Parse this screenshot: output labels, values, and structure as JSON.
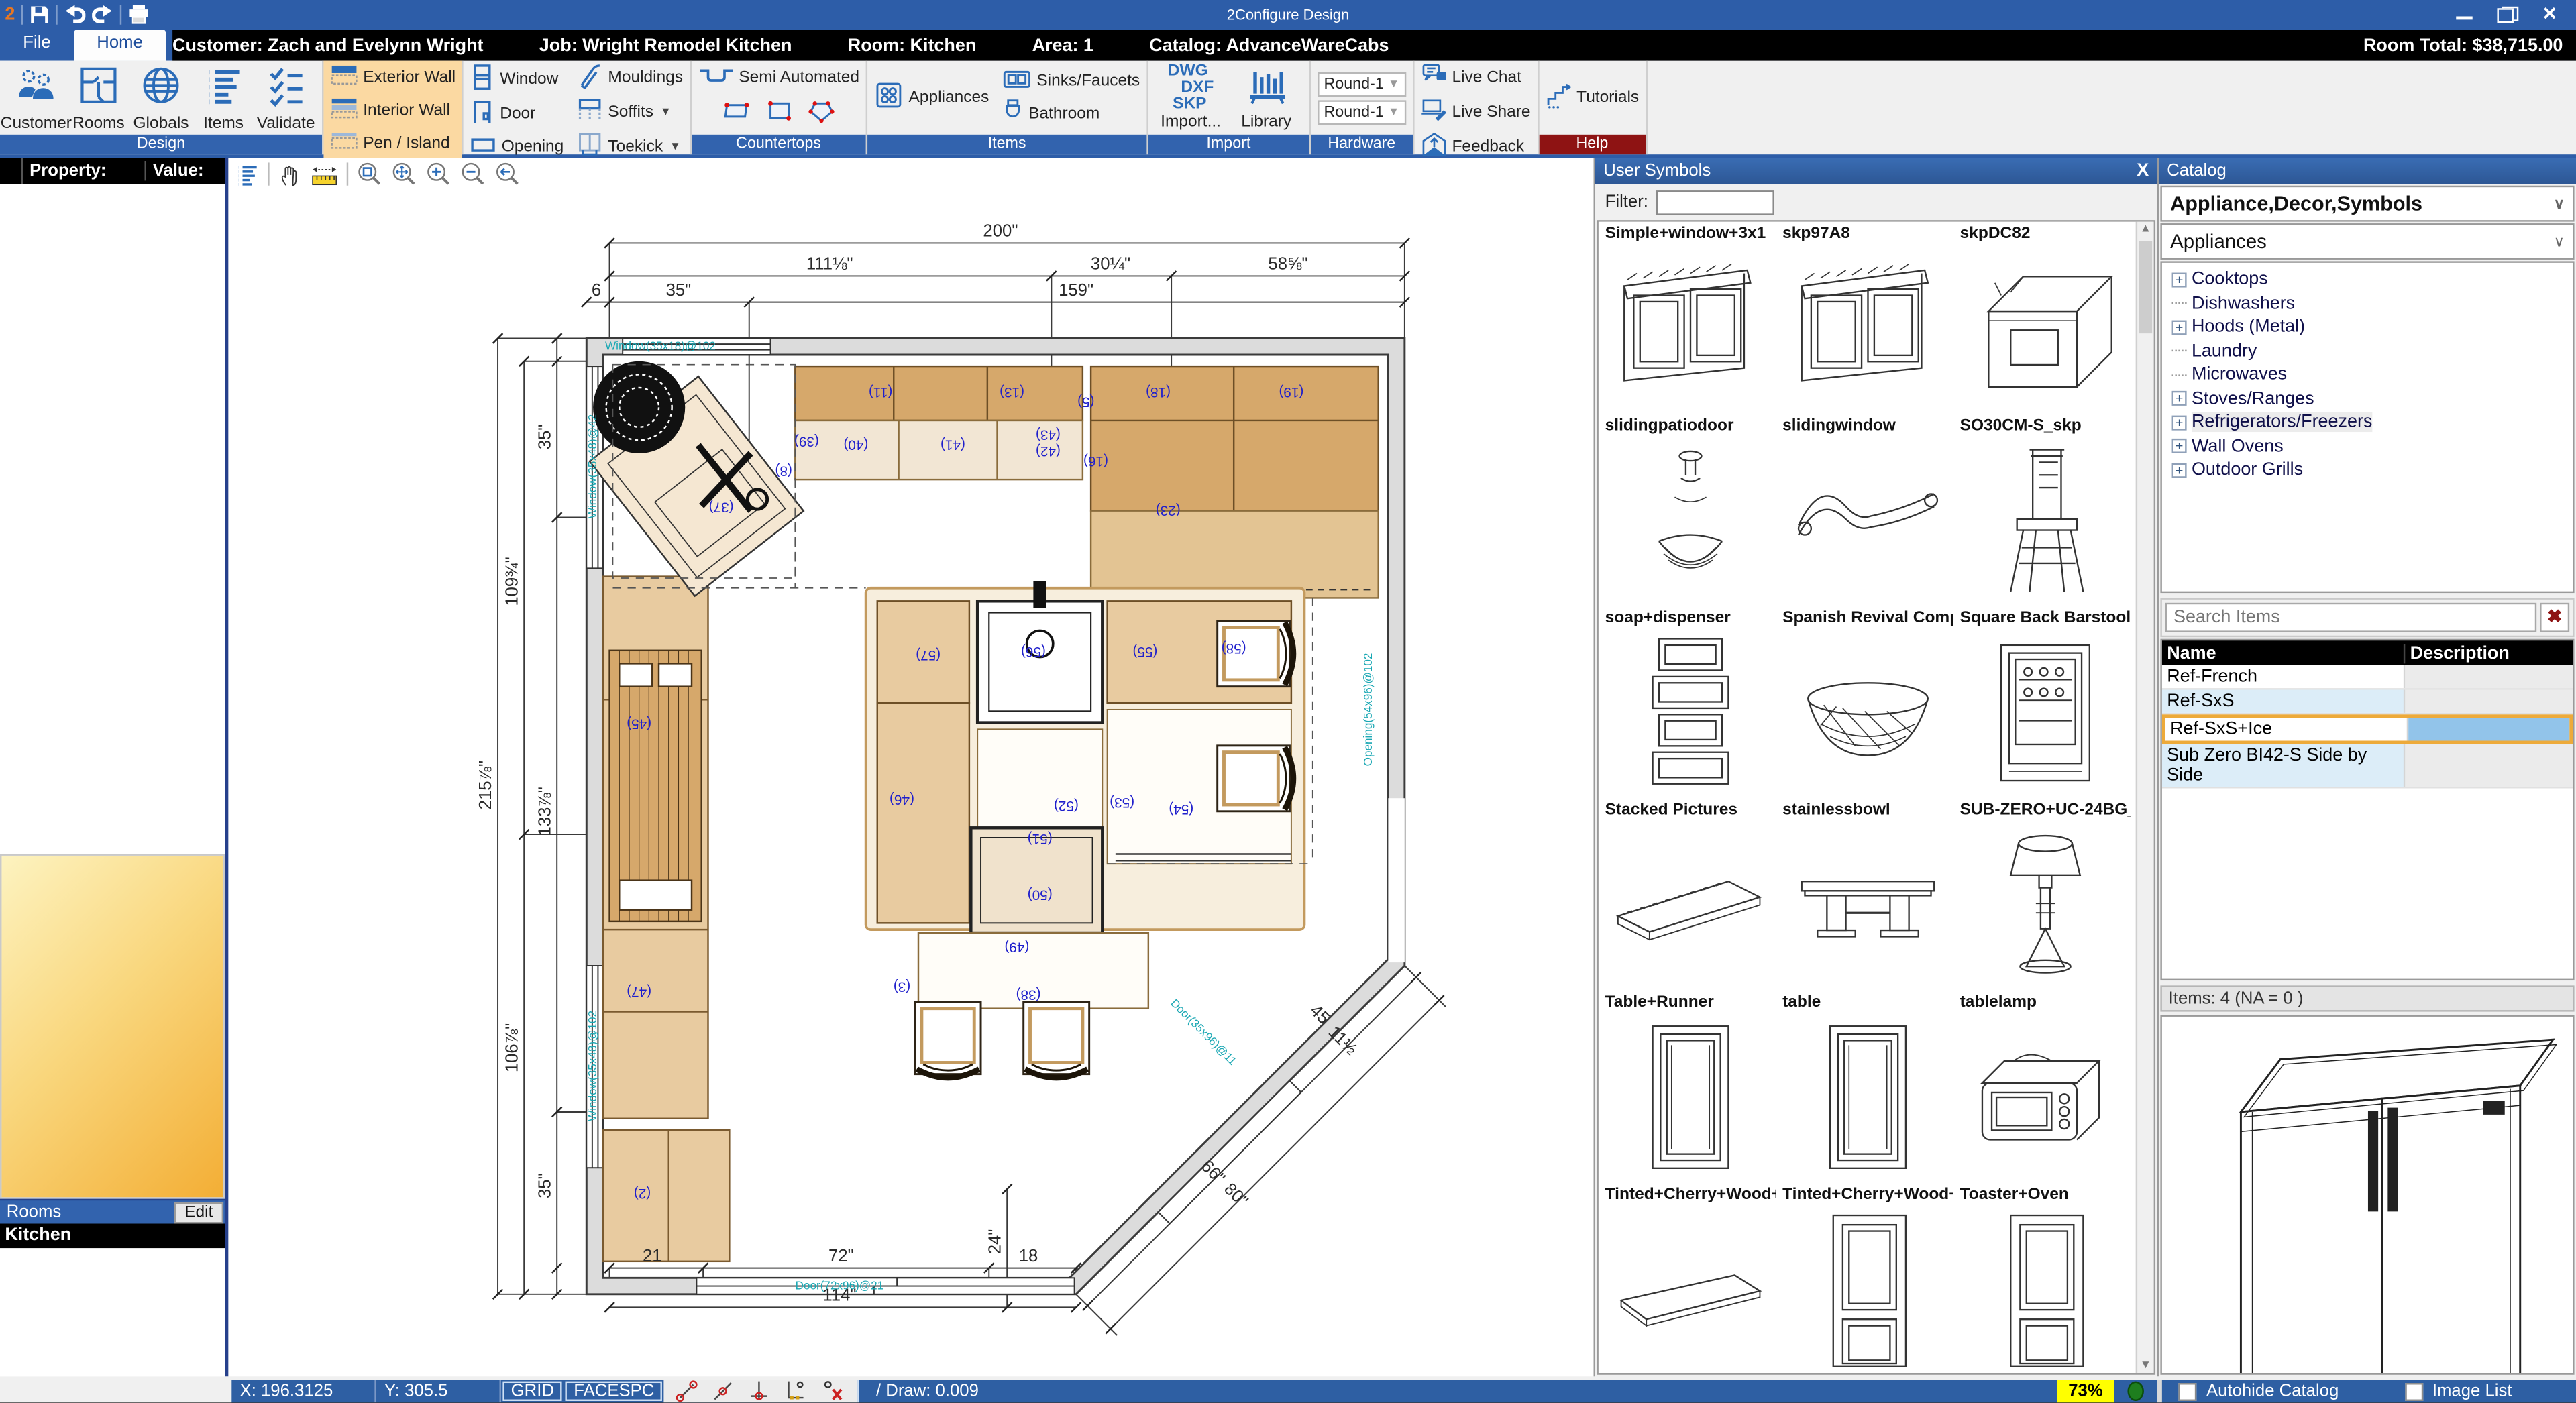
{
  "titlebar": {
    "title": "2Configure Design",
    "logo": "2"
  },
  "infobar": {
    "customer": "Customer: Zach and Evelynn Wright",
    "job": "Job: Wright Remodel Kitchen",
    "room": "Room: Kitchen",
    "area": "Area: 1",
    "catalog": "Catalog: AdvanceWareCabs",
    "room_total": "Room Total: $38,715.00"
  },
  "tabs": [
    {
      "label": "File",
      "active": false
    },
    {
      "label": "Home",
      "active": true
    }
  ],
  "ribbon": {
    "groups": [
      {
        "name": "Design",
        "type": "large",
        "buttons": [
          {
            "label": "Customer",
            "icon": "customer"
          },
          {
            "label": "Rooms",
            "icon": "rooms"
          },
          {
            "label": "Globals",
            "icon": "globe"
          },
          {
            "label": "Items",
            "icon": "itemslist"
          },
          {
            "label": "Validate",
            "icon": "validate"
          }
        ]
      },
      {
        "name": "Sketch Walls",
        "type": "stack",
        "highlight": true,
        "buttons": [
          {
            "label": "Exterior Wall",
            "icon": "wallext"
          },
          {
            "label": "Interior Wall",
            "icon": "wallint"
          },
          {
            "label": "Pen / Island",
            "icon": "wallpen"
          }
        ]
      },
      {
        "name": "Room",
        "type": "cols",
        "cols": [
          [
            {
              "label": "Window",
              "icon": "window"
            },
            {
              "label": "Door",
              "icon": "door"
            },
            {
              "label": "Opening",
              "icon": "opening"
            }
          ],
          [
            {
              "label": "Mouldings",
              "icon": "moulding"
            },
            {
              "label": "Soffits",
              "icon": "soffit",
              "caret": true
            },
            {
              "label": "Toekick",
              "icon": "toekick",
              "caret": true
            }
          ]
        ]
      },
      {
        "name": "Countertops",
        "type": "counter",
        "main": {
          "label": "Semi Automated",
          "icon": "counterauto"
        },
        "shapes": [
          "ctrect",
          "ctsquare",
          "ctpoly"
        ]
      },
      {
        "name": "Items",
        "type": "cols",
        "cols": [
          [
            {
              "label": "Appliances",
              "icon": "appliances"
            }
          ],
          [
            {
              "label": "Sinks/Faucets",
              "icon": "sink"
            },
            {
              "label": "Bathroom",
              "icon": "bath"
            }
          ]
        ]
      },
      {
        "name": "Import",
        "type": "import",
        "import_lines": [
          "DWG",
          "DXF",
          "SKP"
        ],
        "import_label": "Import...",
        "library_label": "Library"
      },
      {
        "name": "Hardware",
        "type": "dropdowns",
        "values": [
          "Round-1",
          "Round-1"
        ]
      },
      {
        "name": "Tech Support",
        "type": "stack",
        "accent": "red",
        "buttons": [
          {
            "label": "Live Chat",
            "icon": "chat"
          },
          {
            "label": "Live Share",
            "icon": "share"
          },
          {
            "label": "Feedback",
            "icon": "feedback"
          }
        ]
      },
      {
        "name": "Help",
        "type": "stack",
        "accent": "red",
        "buttons": [
          {
            "label": "Tutorials",
            "icon": "tutorials"
          }
        ]
      }
    ]
  },
  "left_panel": {
    "property_header": "Property:",
    "value_header": "Value:",
    "rooms_label": "Rooms",
    "edit_button": "Edit",
    "rooms": [
      "Kitchen"
    ]
  },
  "canvas_toolbar": {
    "icons": [
      "layerslist",
      "hand",
      "ruler",
      "zoomwindow",
      "zoomextents",
      "zoomin",
      "zoomout",
      "zoomprev"
    ]
  },
  "floor_plan": {
    "dims": [
      [
        "200\"",
        470,
        48,
        0
      ],
      [
        "111⅛\"",
        366,
        68,
        0
      ],
      [
        "30¼\"",
        537,
        68,
        0
      ],
      [
        "58⅝\"",
        645,
        68,
        0
      ],
      [
        "6",
        224,
        84,
        0
      ],
      [
        "35\"",
        274,
        84,
        0
      ],
      [
        "159\"",
        516,
        84,
        0
      ],
      [
        "215⅞\"",
        160,
        382,
        -90
      ],
      [
        "109¾\"",
        176,
        258,
        -90
      ],
      [
        "106⅞\"",
        176,
        542,
        -90
      ],
      [
        "35\"",
        196,
        170,
        -90
      ],
      [
        "133⅞\"",
        196,
        398,
        -90
      ],
      [
        "35\"",
        196,
        626,
        -90
      ],
      [
        "21",
        258,
        672,
        0
      ],
      [
        "72\"",
        373,
        672,
        0
      ],
      [
        "18",
        487,
        672,
        0
      ],
      [
        "24\"",
        470,
        660,
        -90
      ],
      [
        "114\"",
        372,
        696,
        0
      ],
      [
        "66\"",
        597,
        620,
        45
      ],
      [
        "80\"",
        611,
        634,
        45
      ],
      [
        "11½",
        676,
        540,
        45
      ],
      [
        "45",
        662,
        524,
        45
      ]
    ],
    "items": [
      [
        "(37)",
        300,
        210
      ],
      [
        "(8)",
        338,
        188
      ],
      [
        "(39)",
        352,
        170
      ],
      [
        "(40)",
        382,
        172
      ],
      [
        "(41)",
        441,
        172
      ],
      [
        "(43)",
        499,
        166
      ],
      [
        "(42)",
        499,
        176
      ],
      [
        "(11)",
        397,
        140
      ],
      [
        "(13)",
        477,
        140
      ],
      [
        "(5)",
        522,
        146
      ],
      [
        "(18)",
        566,
        140
      ],
      [
        "(19)",
        647,
        140
      ],
      [
        "(16)",
        528,
        182
      ],
      [
        "(23)",
        572,
        212
      ],
      [
        "(45)",
        250,
        342
      ],
      [
        "(47)",
        250,
        505
      ],
      [
        "(2)",
        252,
        628
      ],
      [
        "(57)",
        426,
        300
      ],
      [
        "(56)",
        490,
        298
      ],
      [
        "(55)",
        558,
        298
      ],
      [
        "(58)",
        612,
        296
      ],
      [
        "(46)",
        410,
        388
      ],
      [
        "(52)",
        510,
        392
      ],
      [
        "(53)",
        544,
        390
      ],
      [
        "(54)",
        580,
        394
      ],
      [
        "(51)",
        494,
        412
      ],
      [
        "(50)",
        494,
        446
      ],
      [
        "(49)",
        480,
        478
      ],
      [
        "(3)",
        410,
        502
      ],
      [
        "(38)",
        487,
        507
      ]
    ],
    "walls": [
      [
        "Window(35x18)@102",
        263,
        117,
        0
      ],
      [
        "Window(35x48)@42",
        224,
        188,
        -90
      ],
      [
        "Window(35x48)@102",
        224,
        553,
        -90
      ],
      [
        "Door(72x96)@21",
        372,
        689,
        0
      ],
      [
        "Opening(54x96)@102",
        696,
        336,
        -90
      ],
      [
        "Door(35x96)@11",
        592,
        534,
        45
      ]
    ]
  },
  "user_symbols": {
    "title": "User Symbols",
    "close": "X",
    "filter_label": "Filter:",
    "filter_value": "",
    "items": [
      {
        "name": "Simple+window+3x1",
        "kind": "window"
      },
      {
        "name": "skp97A8",
        "kind": "window"
      },
      {
        "name": "skpDC82",
        "kind": "oven"
      },
      {
        "name": "slidingpatiodoor",
        "kind": "dispenser"
      },
      {
        "name": "slidingwindow",
        "kind": "pelmet"
      },
      {
        "name": "SO30CM-S_skp",
        "kind": "barstool"
      },
      {
        "name": "soap+dispenser",
        "kind": "frames"
      },
      {
        "name": "Spanish Revival Compl",
        "kind": "bowl"
      },
      {
        "name": "Square Back Barstool",
        "kind": "winecooler"
      },
      {
        "name": "Stacked Pictures",
        "kind": "shelf"
      },
      {
        "name": "stainlessbowl",
        "kind": "table"
      },
      {
        "name": "SUB-ZERO+UC-24BG_0",
        "kind": "lamp"
      },
      {
        "name": "Table+Runner",
        "kind": "doorpanel"
      },
      {
        "name": "table",
        "kind": "doorpanel"
      },
      {
        "name": "tablelamp",
        "kind": "toasteroven"
      },
      {
        "name": "Tinted+Cherry+Wood+",
        "kind": "flatshelf"
      },
      {
        "name": "Tinted+Cherry+Wood+",
        "kind": "talldoor"
      },
      {
        "name": "Toaster+Oven",
        "kind": "talldoor"
      }
    ]
  },
  "catalog": {
    "title": "Catalog",
    "catalog_select": "Appliance,Decor,Symbols",
    "category_select": "Appliances",
    "tree": [
      {
        "label": "Cooktops",
        "plus": true
      },
      {
        "label": "Dishwashers",
        "plus": false
      },
      {
        "label": "Hoods (Metal)",
        "plus": true
      },
      {
        "label": "Laundry",
        "plus": false
      },
      {
        "label": "Microwaves",
        "plus": false
      },
      {
        "label": "Stoves/Ranges",
        "plus": true
      },
      {
        "label": "Refrigerators/Freezers",
        "plus": true,
        "selected": true
      },
      {
        "label": "Wall Ovens",
        "plus": true
      },
      {
        "label": "Outdoor Grills",
        "plus": true
      }
    ],
    "search_placeholder": "Search Items",
    "columns": [
      "Name",
      "Description"
    ],
    "rows": [
      {
        "name": "Ref-French",
        "desc": "",
        "alt": false
      },
      {
        "name": "Ref-SxS",
        "desc": "",
        "alt": true
      },
      {
        "name": "Ref-SxS+Ice",
        "desc": "",
        "selected": true
      },
      {
        "name": "Sub Zero BI42-S Side by Side",
        "desc": "",
        "alt": true
      }
    ],
    "items_count": "Items: 4  (NA = 0 )",
    "autohide_label": "Autohide Catalog",
    "imagelist_label": "Image List"
  },
  "statusbar": {
    "x": "X: 196.3125",
    "y": "Y: 305.5",
    "grid": "GRID",
    "facespc": "FACESPC",
    "draw": "/ Draw: 0.009",
    "pct": "73%"
  }
}
